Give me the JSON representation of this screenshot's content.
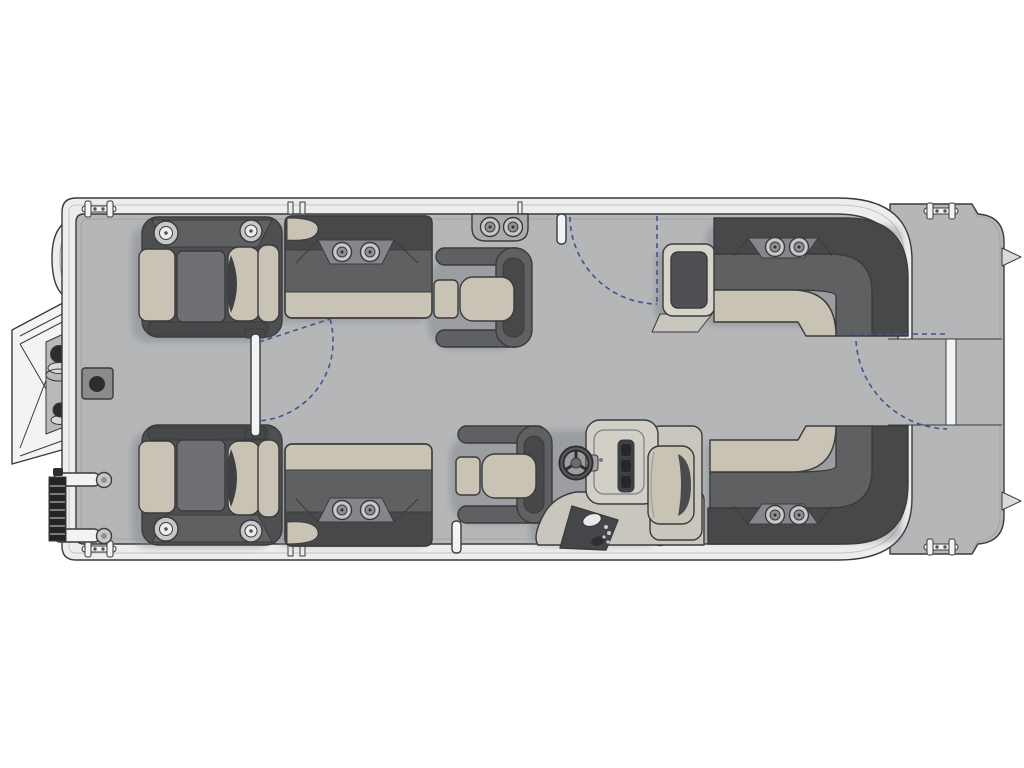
{
  "page": {
    "title": "Pontoon boat floor plan — top-down deck layout diagram"
  },
  "colors": {
    "page_bg": "#ffffff",
    "outline": "#3a3b3c",
    "deck": "#b4b6b8",
    "band": "#eceded",
    "seat_dark": "#47484a",
    "seat_mid": "#5f6062",
    "cushion": "#c9c3b6",
    "chair_frame": "#4e4f51",
    "chair_panel": "#6f7073",
    "console": "#d2cfc7",
    "console_base": "#c9c6be",
    "pod_dark": "#45464a",
    "metal": "#c7c8ca",
    "metal_dark": "#8e9093",
    "gate_white": "#f2f3f4",
    "ink": "#2c2d2f",
    "arc": "#4b4f91",
    "shadow": "#7d8085",
    "accent_line": "#a2a4a6",
    "plate": "#898b8d"
  },
  "diagram": {
    "type": "floorplan",
    "subject": "pontoon boat deck, bow at left, stern at right",
    "components": [
      {
        "id": "bow-boarding-gate",
        "label": "Bow boarding gate (open, exterior)"
      },
      {
        "id": "boarding-ladder",
        "label": "Boarding ladder (stowed, bow)"
      },
      {
        "id": "bow-panel",
        "label": "Bow corner panel"
      },
      {
        "id": "tow-base",
        "label": "Deck plate fitting (bow)"
      },
      {
        "id": "captain-chair-top",
        "label": "Bow captain chair (top)"
      },
      {
        "id": "captain-chair-bottom",
        "label": "Bow captain chair (bottom)"
      },
      {
        "id": "bow-center-gate",
        "label": "Bow center gate with swing arc"
      },
      {
        "id": "bench-top",
        "label": "Forward bench seat with cup holders (top)"
      },
      {
        "id": "bench-bottom",
        "label": "Forward bench seat with cup holders (bottom)"
      },
      {
        "id": "lounge-top",
        "label": "Swingback lounge chair (top)"
      },
      {
        "id": "lounge-bottom",
        "label": "Swingback lounge chair (helm side)"
      },
      {
        "id": "wall-cup-holder",
        "label": "Rail-mounted double cup holder"
      },
      {
        "id": "side-gate-top",
        "label": "Side boarding gate with swing arc (top)"
      },
      {
        "id": "helm-console",
        "label": "Helm console with steering wheel"
      },
      {
        "id": "helm-seat",
        "label": "Helm companion seat"
      },
      {
        "id": "armrest-table",
        "label": "Aft bench armrest table"
      },
      {
        "id": "l-bench-top",
        "label": "Aft wraparound L-bench (top)"
      },
      {
        "id": "l-bench-bottom",
        "label": "Aft wraparound L-bench (bottom)"
      },
      {
        "id": "stern-gate",
        "label": "Stern gate with swing arc"
      },
      {
        "id": "stern-platform",
        "label": "Stern platform"
      },
      {
        "id": "cleat",
        "label": "Mooring cleat"
      },
      {
        "id": "gate-post",
        "label": "Gate post"
      },
      {
        "id": "deck-fittings",
        "label": "Aft deck fittings"
      }
    ]
  }
}
